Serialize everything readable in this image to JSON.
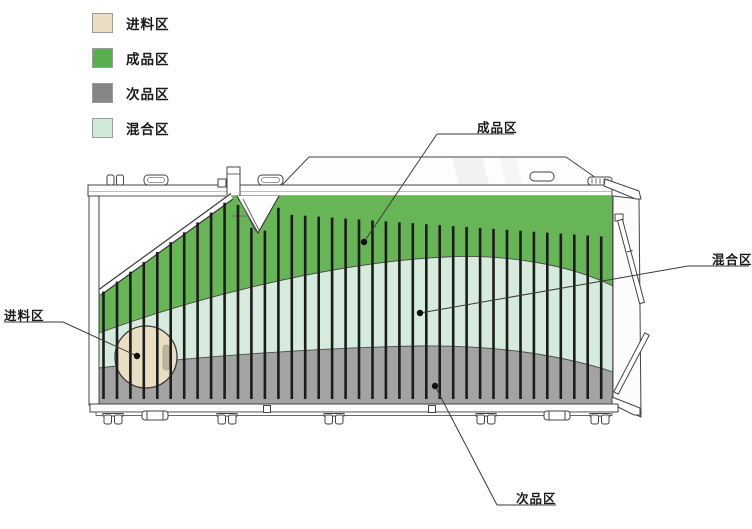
{
  "legend": {
    "items": [
      {
        "id": "feed",
        "label": "进料区"
      },
      {
        "id": "finished",
        "label": "成品区"
      },
      {
        "id": "reject",
        "label": "次品区"
      },
      {
        "id": "mixed",
        "label": "混合区"
      }
    ]
  },
  "callouts": {
    "finished": {
      "label": "成品区"
    },
    "mixed": {
      "label": "混合区"
    },
    "feed": {
      "label": "进料区"
    },
    "reject": {
      "label": "次品区"
    }
  },
  "machine": {
    "zones": [
      "进料区",
      "成品区",
      "次品区",
      "混合区"
    ],
    "bar_count": 38
  },
  "colors": {
    "feed": "#e9ddc4",
    "finished": "#57b04c",
    "reject_legend": "#868686",
    "mixed": "#cfe8d8",
    "machine_green": "#68b557",
    "machine_mint": "#d5ebdd",
    "machine_gray": "#a3a3a3",
    "bar": "#1c1c1c",
    "line": "#3a3a3a",
    "dot": "#101010"
  }
}
